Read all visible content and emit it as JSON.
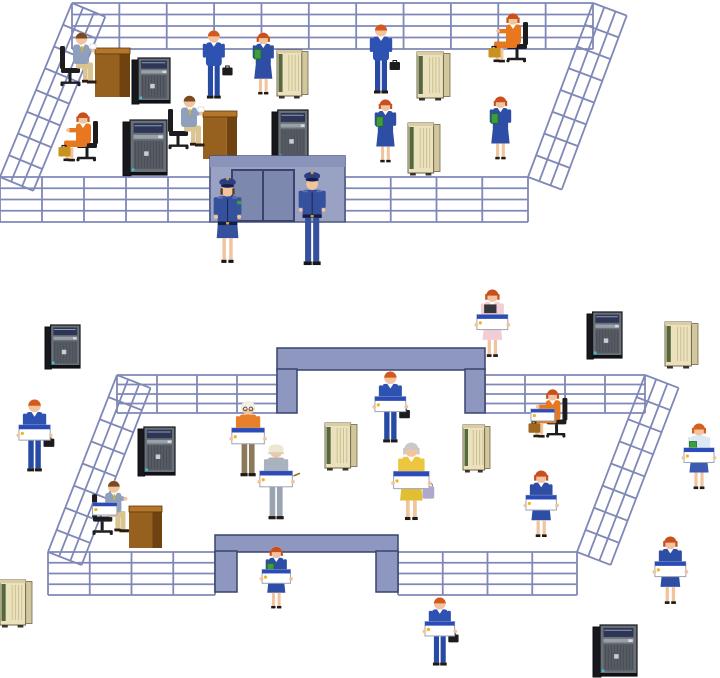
{
  "scene": {
    "canvas": {
      "w": 720,
      "h": 678,
      "background": "#ffffff"
    },
    "palette": {
      "fence": "#7f88b7",
      "gate_face": "#9aa2c4",
      "gate_top": "#8a93ba",
      "gate_door": "#7d88ae",
      "gate_doorframe": "#39436e",
      "gate_outline": "#4a5483",
      "arch_fill": "#8e97c0",
      "arch_outline": "#39436e",
      "chair": "#1d1d20",
      "laptop_bar": "#2b4bb8",
      "laptop_dot": "#f0b41e",
      "skin": "#f2c49e",
      "desk_top": "#b5762a",
      "desk_front": "#96601e",
      "desk_side": "#6f430f",
      "tower_body": "#17181d",
      "tower_front": "#697077",
      "tower_screen": "#2e3656",
      "mainframe_front": "#ebe2bd",
      "mainframe_side": "#d2c79c",
      "mainframe_green": "#55673f"
    },
    "layers": [
      "upper-back-fence",
      "upper-interior",
      "upper-front-fence",
      "upper-gate",
      "upper-foreground",
      "lower-outside",
      "lower-back-fence",
      "lower-interior",
      "lower-front-fence",
      "lower-foreground"
    ],
    "items": [
      {
        "type": "band",
        "layer": "upper-back-fence",
        "id": "fence-upper-back",
        "x": 72,
        "y": 3,
        "w": 521,
        "h": 46,
        "rows": 4,
        "cols": 11
      },
      {
        "type": "slant",
        "layer": "upper-back-fence",
        "id": "fence-upper-left-slant",
        "x1": 72,
        "y1": 3,
        "x2": 0,
        "y2": 177,
        "rails": 4,
        "gap": 12,
        "ties": 8
      },
      {
        "type": "slant",
        "layer": "upper-back-fence",
        "id": "fence-upper-right-slant",
        "x1": 593,
        "y1": 3,
        "x2": 528,
        "y2": 177,
        "rails": 4,
        "gap": 12,
        "ties": 8
      },
      {
        "type": "desk",
        "layer": "upper-interior",
        "id": "desk-1",
        "x": 95,
        "y": 48,
        "w": 35,
        "h": 49,
        "z": 60
      },
      {
        "type": "person",
        "layer": "upper-interior",
        "id": "clerk-at-desk-1",
        "pose": "desk-sit",
        "x": 60,
        "y": 31,
        "h": 66,
        "hair": "#7a4a20",
        "top": "#8fa0bd",
        "bottom": "#d9c492",
        "tie": "#e2b410",
        "paper": true
      },
      {
        "type": "tower",
        "layer": "upper-interior",
        "id": "server-tower-1",
        "x": 132,
        "y": 58,
        "w": 38,
        "h": 47
      },
      {
        "type": "mainframe",
        "layer": "upper-interior",
        "id": "mainframe-1",
        "x": 277,
        "y": 50,
        "w": 31,
        "h": 48
      },
      {
        "type": "person",
        "layer": "upper-interior",
        "id": "businessman-standing-1",
        "pose": "stand",
        "x": 201,
        "y": 30,
        "h": 71,
        "hair": "#d4591e",
        "top": "#2d52b2",
        "bottomType": "pants",
        "bottom": "#274aa4",
        "briefcase": "#1c1c1f",
        "collar": true
      },
      {
        "type": "person",
        "layer": "upper-interior",
        "id": "businesswoman-folder-1",
        "pose": "stand",
        "x": 251,
        "y": 32,
        "h": 68,
        "hair": "#c8501e",
        "top": "#2e4ea6",
        "bottomType": "skirt",
        "bottom": "#2e4ea6",
        "folder": "#3e9e3e",
        "collar": true
      },
      {
        "type": "person",
        "layer": "upper-interior",
        "id": "businesswoman-orange-seated-1",
        "pose": "chair-sit",
        "x": 58,
        "y": 111,
        "h": 62,
        "hair": "#c8501e",
        "top": "#e87820",
        "bottom": "#e87820",
        "briefcase": "#c8921e",
        "collar": true
      },
      {
        "type": "desk",
        "layer": "upper-interior",
        "id": "desk-2",
        "x": 203,
        "y": 111,
        "w": 34,
        "h": 48,
        "z": 120
      },
      {
        "type": "person",
        "layer": "upper-interior",
        "id": "clerk-at-desk-2",
        "pose": "desk-sit",
        "x": 168,
        "y": 94,
        "h": 66,
        "hair": "#7a4a20",
        "top": "#8fa0bd",
        "bottom": "#d9c492",
        "tie": "#e2b410",
        "paper": true
      },
      {
        "type": "tower",
        "layer": "upper-interior",
        "id": "server-tower-2",
        "x": 123,
        "y": 120,
        "w": 44,
        "h": 57
      },
      {
        "type": "tower",
        "layer": "upper-interior",
        "id": "server-tower-3",
        "x": 272,
        "y": 110,
        "w": 36,
        "h": 53
      },
      {
        "type": "person",
        "layer": "upper-interior",
        "id": "businessman-standing-2",
        "pose": "stand",
        "x": 368,
        "y": 24,
        "h": 72,
        "hair": "#d4591e",
        "top": "#2d52b2",
        "bottomType": "pants",
        "bottom": "#274aa4",
        "briefcase": "#1c1c1f",
        "collar": true
      },
      {
        "type": "mainframe",
        "layer": "upper-interior",
        "id": "mainframe-2",
        "x": 417,
        "y": 52,
        "w": 33,
        "h": 48
      },
      {
        "type": "person",
        "layer": "upper-interior",
        "id": "businesswoman-orange-seated-2",
        "pose": "chair-sit",
        "x": 488,
        "y": 12,
        "h": 62,
        "hair": "#c8501e",
        "top": "#e87820",
        "bottom": "#e87820",
        "briefcase": "#c8921e",
        "collar": true
      },
      {
        "type": "person",
        "layer": "upper-interior",
        "id": "businesswoman-folder-2",
        "pose": "stand",
        "x": 373,
        "y": 99,
        "h": 69,
        "hair": "#c8501e",
        "top": "#2e4ea6",
        "bottomType": "skirt",
        "bottom": "#2e4ea6",
        "folder": "#3e9e3e",
        "collar": true
      },
      {
        "type": "mainframe",
        "layer": "upper-interior",
        "id": "mainframe-3",
        "x": 408,
        "y": 123,
        "w": 32,
        "h": 52
      },
      {
        "type": "person",
        "layer": "upper-interior",
        "id": "businesswoman-folder-3",
        "pose": "stand",
        "x": 488,
        "y": 96,
        "h": 69,
        "hair": "#c8501e",
        "top": "#2e4ea6",
        "bottomType": "skirt",
        "bottom": "#2e4ea6",
        "folder": "#3e9e3e",
        "collar": true
      },
      {
        "type": "band",
        "layer": "upper-front-fence",
        "id": "fence-upper-front-left",
        "x": 0,
        "y": 177,
        "w": 210,
        "h": 45,
        "rows": 4,
        "cols": 5
      },
      {
        "type": "band",
        "layer": "upper-front-fence",
        "id": "fence-upper-front-right",
        "x": 345,
        "y": 177,
        "w": 183,
        "h": 45,
        "rows": 4,
        "cols": 4
      },
      {
        "type": "gate",
        "layer": "upper-gate",
        "id": "gate-upper",
        "x": 210,
        "y": 156,
        "w": 135,
        "h": 66
      },
      {
        "type": "person",
        "layer": "upper-foreground",
        "id": "guard-female",
        "pose": "guard",
        "female": true,
        "x": 211,
        "y": 176,
        "h": 90,
        "top": "#35509c",
        "hair": "#5a3a1a"
      },
      {
        "type": "person",
        "layer": "upper-foreground",
        "id": "guard-male",
        "pose": "guard",
        "x": 296,
        "y": 170,
        "h": 99,
        "top": "#35509c",
        "hair": "#3a2a14"
      },
      {
        "type": "tower",
        "layer": "lower-outside",
        "id": "server-tower-4",
        "x": 45,
        "y": 325,
        "w": 35,
        "h": 45
      },
      {
        "type": "tower",
        "layer": "lower-outside",
        "id": "server-tower-5",
        "x": 587,
        "y": 312,
        "w": 35,
        "h": 48
      },
      {
        "type": "mainframe",
        "layer": "lower-outside",
        "id": "mainframe-4",
        "x": 665,
        "y": 322,
        "w": 33,
        "h": 46
      },
      {
        "type": "person",
        "layer": "lower-outside",
        "id": "laptop-businessman-outside-left",
        "pose": "stand",
        "x": 21,
        "y": 399,
        "h": 75,
        "hair": "#d4591e",
        "top": "#2d52b2",
        "bottomType": "pants",
        "bottom": "#274aa4",
        "laptop": true,
        "briefcase": "#1c1c1f",
        "collar": true
      },
      {
        "type": "person",
        "layer": "lower-outside",
        "id": "nurse-pink-laptop",
        "pose": "stand",
        "x": 479,
        "y": 289,
        "h": 74,
        "hair": "#c8501e",
        "top": "#f3cdd6",
        "bottomType": "skirt",
        "bottom": "#f3cdd6",
        "clipboard": "#36343c",
        "laptop": true,
        "collar": true
      },
      {
        "type": "person",
        "layer": "lower-outside",
        "id": "labcoat-woman-laptop",
        "pose": "stand",
        "x": 686,
        "y": 423,
        "h": 72,
        "hair": "#d4601e",
        "top": "#dce9f4",
        "bottomType": "skirt",
        "bottom": "#3b5bb0",
        "folder": "#3e9e3e",
        "laptop": true
      },
      {
        "type": "band",
        "layer": "lower-back-fence",
        "id": "fence-lower-back-left",
        "x": 117,
        "y": 375,
        "w": 160,
        "h": 38,
        "rows": 4,
        "cols": 4
      },
      {
        "type": "band",
        "layer": "lower-back-fence",
        "id": "fence-lower-back-right",
        "x": 485,
        "y": 375,
        "w": 160,
        "h": 38,
        "rows": 4,
        "cols": 4
      },
      {
        "type": "slant",
        "layer": "lower-back-fence",
        "id": "fence-lower-left-slant",
        "x1": 117,
        "y1": 375,
        "x2": 48,
        "y2": 552,
        "rails": 4,
        "gap": 12,
        "ties": 8
      },
      {
        "type": "slant",
        "layer": "lower-back-fence",
        "id": "fence-lower-right-slant",
        "x1": 645,
        "y1": 375,
        "x2": 577,
        "y2": 552,
        "rails": 4,
        "gap": 12,
        "ties": 8
      },
      {
        "type": "arch",
        "layer": "lower-back-fence",
        "id": "arch-gate-back",
        "x": 277,
        "y": 348,
        "w": 208,
        "barH": 22,
        "colW": 20,
        "colH": 43
      },
      {
        "type": "person",
        "layer": "lower-interior",
        "id": "laptop-businessman-inner-gate",
        "pose": "stand",
        "x": 377,
        "y": 371,
        "h": 74,
        "hair": "#d4591e",
        "top": "#2d52b2",
        "bottomType": "pants",
        "bottom": "#274aa4",
        "laptop": true,
        "briefcase": "#1c1c1f",
        "collar": true
      },
      {
        "type": "tower",
        "layer": "lower-interior",
        "id": "server-tower-6",
        "x": 138,
        "y": 427,
        "w": 37,
        "h": 50
      },
      {
        "type": "mainframe",
        "layer": "lower-interior",
        "id": "mainframe-5",
        "x": 325,
        "y": 423,
        "w": 32,
        "h": 47
      },
      {
        "type": "mainframe",
        "layer": "lower-interior",
        "id": "mainframe-6",
        "x": 463,
        "y": 425,
        "w": 27,
        "h": 47
      },
      {
        "type": "person",
        "layer": "lower-interior",
        "id": "elderly-man-orange-laptop",
        "pose": "stand",
        "x": 234,
        "y": 401,
        "h": 78,
        "hair": "#cfcfcf",
        "hat": "cap-white",
        "top": "#e87f2a",
        "bottomType": "pants",
        "bottom": "#8a7a5a",
        "laptop": true,
        "glasses": true
      },
      {
        "type": "person",
        "layer": "lower-interior",
        "id": "worker-helmet-laptop",
        "pose": "stand",
        "x": 262,
        "y": 444,
        "h": 78,
        "hair": "#555555",
        "hat": "helmet",
        "top": "#a9b2bf",
        "bottomType": "pants",
        "bottom": "#9aa3b0",
        "laptop": true,
        "pencil": true
      },
      {
        "type": "person",
        "layer": "lower-interior",
        "id": "elderly-woman-yellow-laptop",
        "pose": "stand",
        "x": 396,
        "y": 442,
        "h": 85,
        "hair": "#c9c9c9",
        "top": "#ecc63e",
        "bottomType": "skirt",
        "bottom": "#e2be32",
        "handbag": "#b0a8cc",
        "laptop": true,
        "collar": true
      },
      {
        "type": "person",
        "layer": "lower-interior",
        "id": "businesswoman-orange-laptop-seated",
        "pose": "chair-sit",
        "x": 528,
        "y": 388,
        "h": 61,
        "hair": "#c8501e",
        "top": "#e87820",
        "bottom": "#e87820",
        "laptop": true,
        "briefcase": "#a0671e",
        "collar": true
      },
      {
        "type": "person",
        "layer": "lower-interior",
        "id": "businesswoman-laptop-inside",
        "pose": "stand",
        "x": 528,
        "y": 470,
        "h": 73,
        "hair": "#c8501e",
        "top": "#2e4ea6",
        "bottomType": "skirt",
        "bottom": "#2e4ea6",
        "laptop": true,
        "collar": true
      },
      {
        "type": "desk",
        "layer": "lower-interior",
        "id": "desk-3",
        "x": 129,
        "y": 506,
        "w": 33,
        "h": 42,
        "z": 500
      },
      {
        "type": "person",
        "layer": "lower-interior",
        "id": "clerk-at-desk-laptop",
        "pose": "desk-sit",
        "x": 92,
        "y": 479,
        "h": 67,
        "hair": "#7a4a20",
        "top": "#8fa0bd",
        "bottom": "#d9c492",
        "tie": "#e2b410",
        "laptop": true
      },
      {
        "type": "band",
        "layer": "lower-front-fence",
        "id": "fence-lower-front-left",
        "x": 48,
        "y": 552,
        "w": 167,
        "h": 43,
        "rows": 4,
        "cols": 4
      },
      {
        "type": "band",
        "layer": "lower-front-fence",
        "id": "fence-lower-front-right",
        "x": 398,
        "y": 552,
        "w": 179,
        "h": 43,
        "rows": 4,
        "cols": 4
      },
      {
        "type": "arch",
        "layer": "lower-front-fence",
        "id": "arch-gate-front",
        "x": 215,
        "y": 535,
        "w": 183,
        "barH": 17,
        "colW": 22,
        "colH": 40
      },
      {
        "type": "person",
        "layer": "lower-foreground",
        "id": "businesswoman-laptop-front-gate",
        "pose": "stand",
        "x": 264,
        "y": 546,
        "h": 68,
        "hair": "#c8501e",
        "top": "#2e4ea6",
        "bottomType": "skirt",
        "bottom": "#2e4ea6",
        "folder": "#3e9e3e",
        "laptop": true,
        "collar": true
      },
      {
        "type": "person",
        "layer": "lower-foreground",
        "id": "businesswoman-laptop-outside-right",
        "pose": "stand",
        "x": 657,
        "y": 536,
        "h": 74,
        "hair": "#c8501e",
        "top": "#2e4ea6",
        "bottomType": "skirt",
        "bottom": "#2e4ea6",
        "laptop": true,
        "collar": true
      },
      {
        "type": "person",
        "layer": "lower-foreground",
        "id": "laptop-businessman-outside-bottom",
        "pose": "stand",
        "x": 427,
        "y": 597,
        "h": 71,
        "hair": "#d4591e",
        "top": "#2d52b2",
        "bottomType": "pants",
        "bottom": "#274aa4",
        "laptop": true,
        "briefcase": "#1c1c1f",
        "collar": true
      },
      {
        "type": "tower",
        "layer": "lower-foreground",
        "id": "server-tower-7",
        "x": 593,
        "y": 625,
        "w": 44,
        "h": 53
      },
      {
        "type": "mainframe",
        "layer": "lower-foreground",
        "id": "mainframe-7",
        "x": 0,
        "y": 580,
        "w": 32,
        "h": 47
      }
    ]
  }
}
